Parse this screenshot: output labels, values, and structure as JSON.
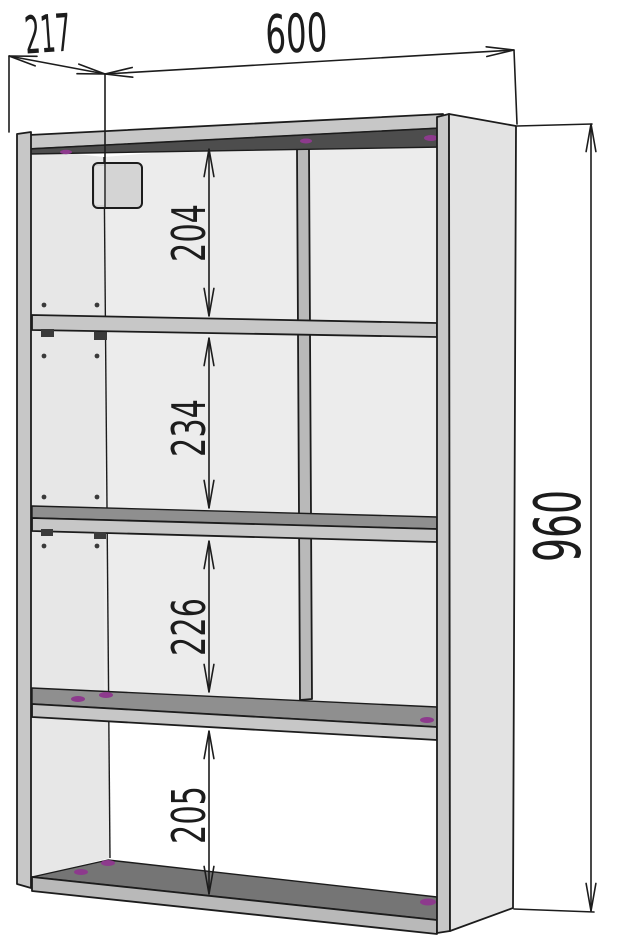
{
  "drawing": {
    "title": "shelf-unit-dimension-drawing",
    "dimensions": {
      "depth": {
        "label": "217"
      },
      "width": {
        "label": "600"
      },
      "height": {
        "label": "960"
      },
      "compartments": [
        {
          "position": "top",
          "label": "204"
        },
        {
          "position": "upper-middle",
          "label": "234"
        },
        {
          "position": "lower-middle",
          "label": "226"
        },
        {
          "position": "bottom",
          "label": "205"
        }
      ]
    }
  },
  "colors": {
    "background": "#ffffff",
    "line": "#1c1c1c",
    "back_panel": "#ececec",
    "inner_face": "#e7e7e7",
    "side_panel": "#e3e3e3",
    "edge_gray": "#c7c7c7",
    "divider_gray": "#b9b9b9",
    "underside_dark": "#4d4d4d",
    "shelf_top_gray": "#8f8f8f",
    "bottom_top_gray": "#757575",
    "bracket_gray": "#d4d4d4",
    "fitting_dark": "#3a3a3a",
    "cam_purple": "#8d3a8d"
  }
}
